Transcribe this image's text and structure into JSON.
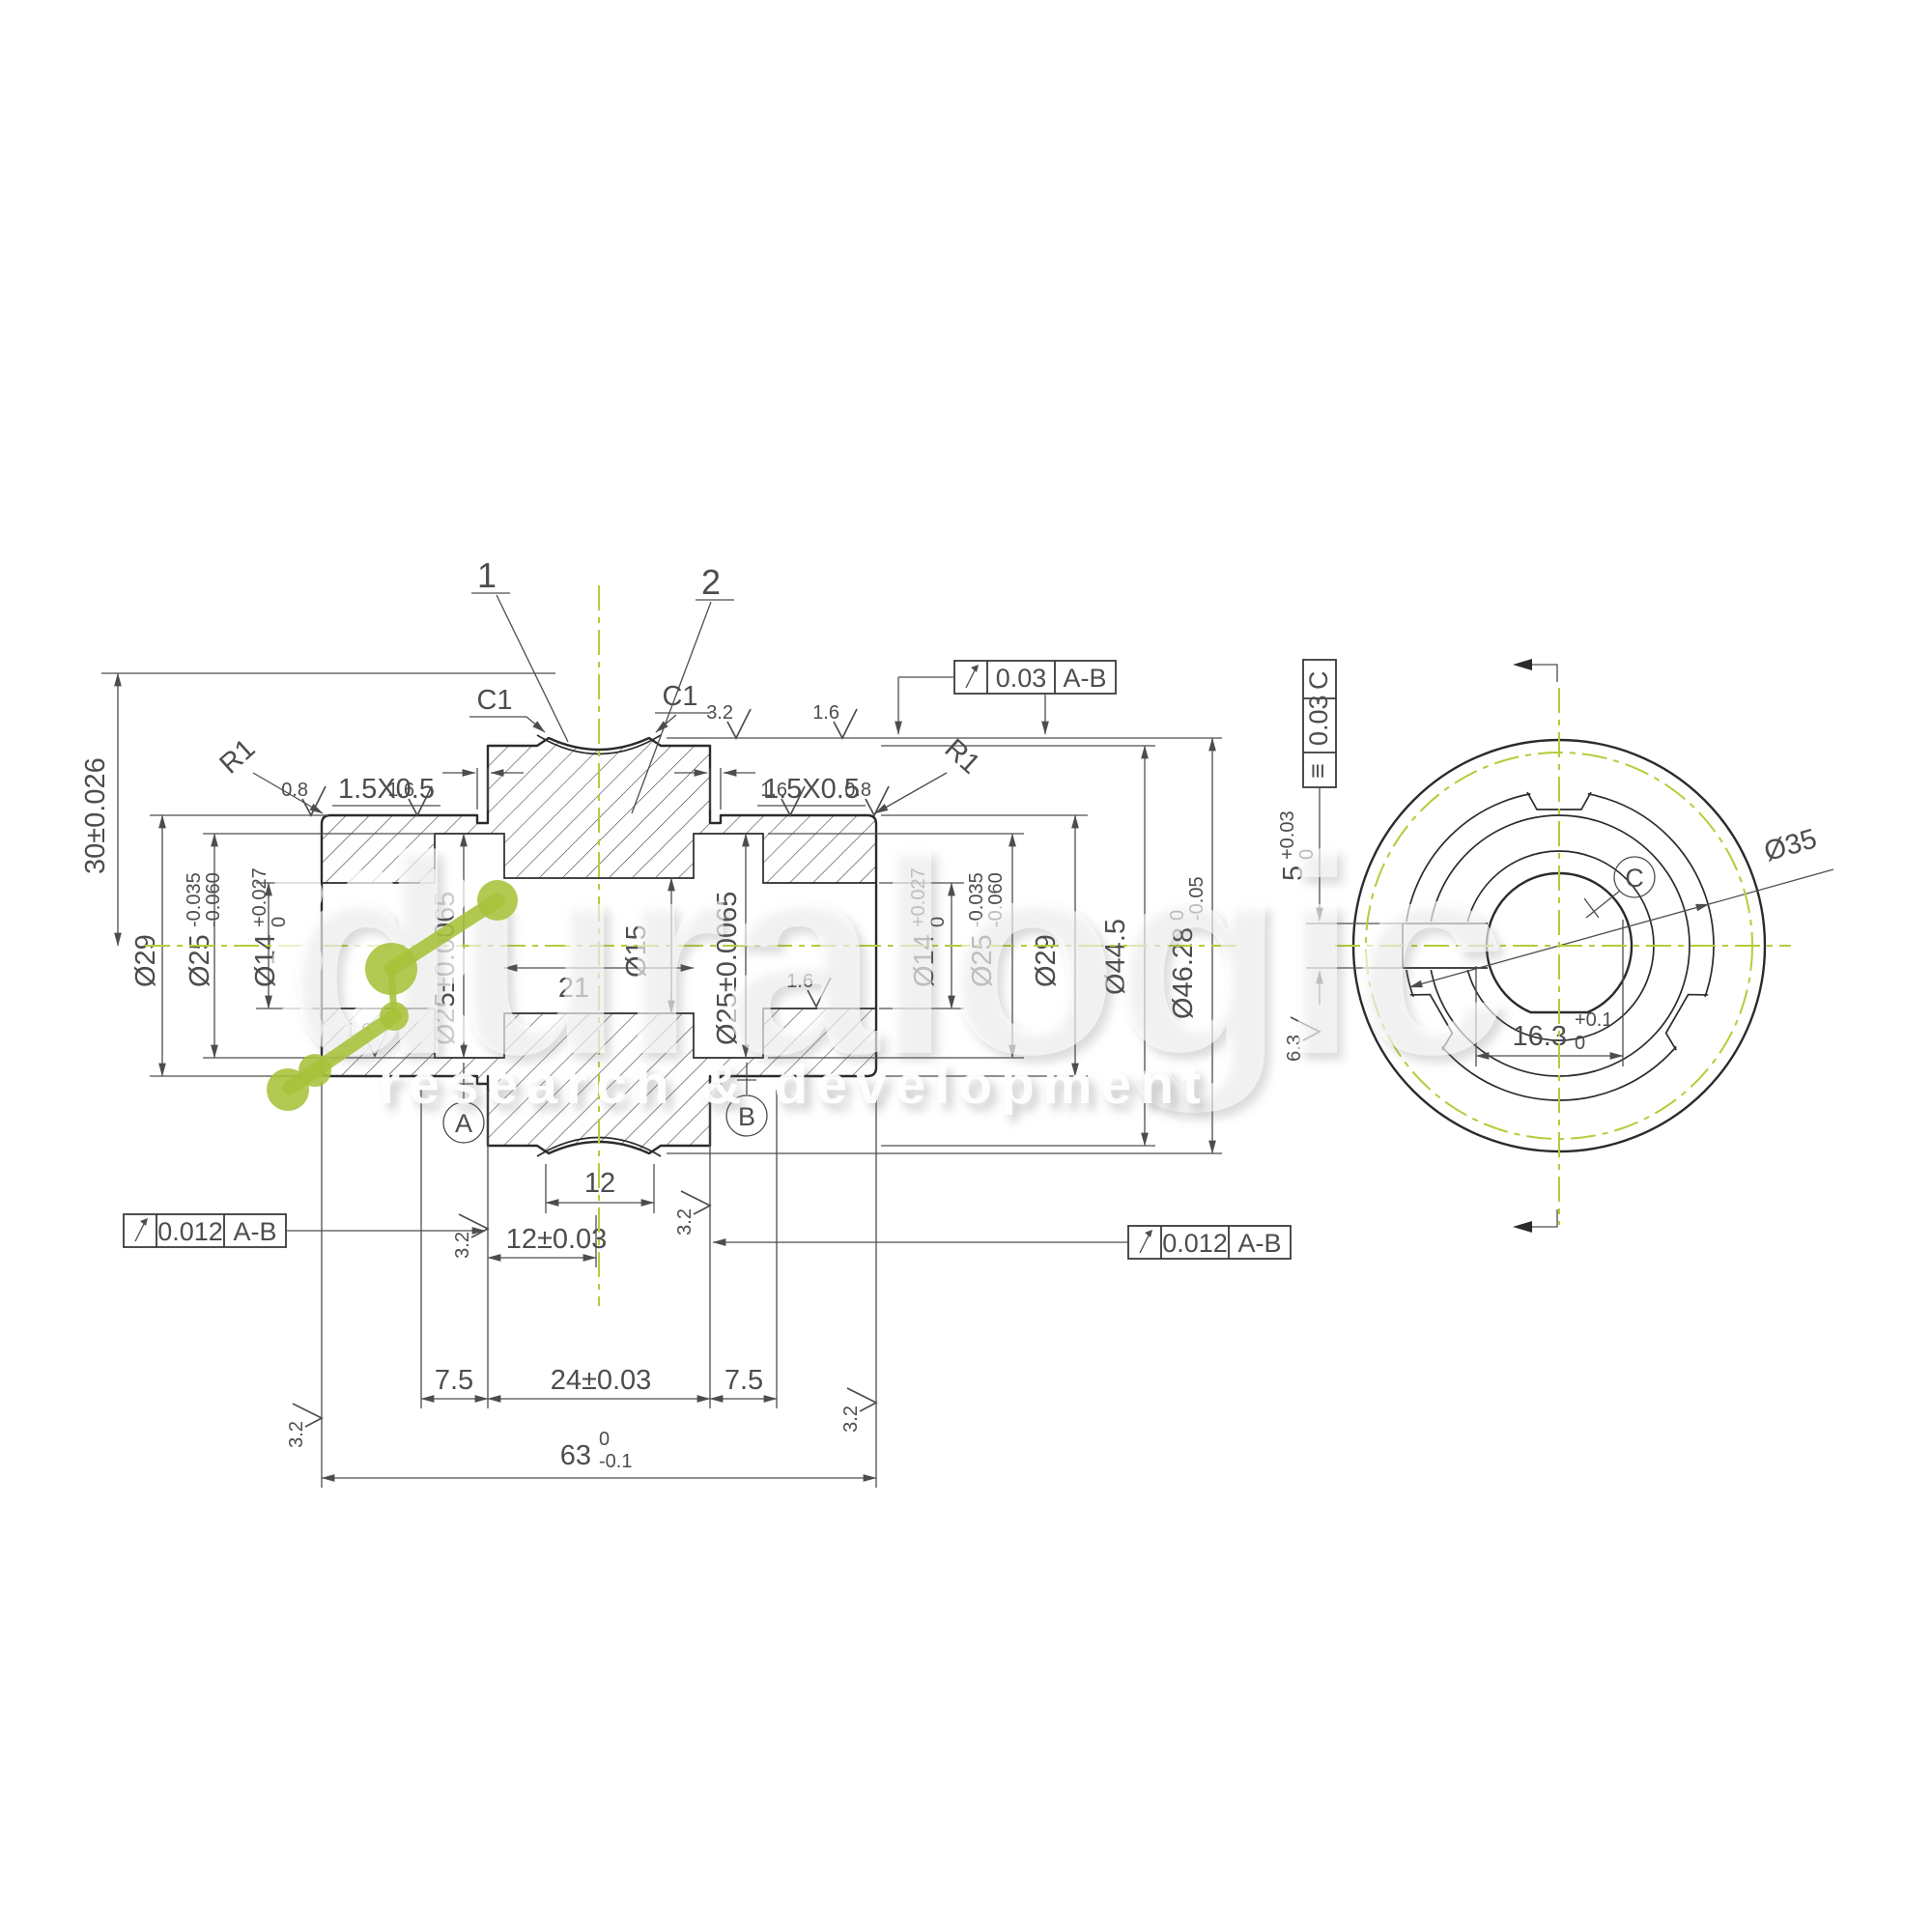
{
  "watermark": {
    "brand": "duralogic",
    "tagline": "research & development"
  },
  "colors": {
    "line": "#2b2b2b",
    "dim_text": "#4d4d4d",
    "centerline_green": "#b5cc3a",
    "logo_green": "#a7c23a"
  },
  "balloons": {
    "item1": "1",
    "item2": "2"
  },
  "labels": {
    "chamfer_c1": "C1",
    "corner_chamfer": "1.5X0.5",
    "fillet_r1": "R1"
  },
  "finish": {
    "f08": "0.8",
    "f16": "1.6",
    "f32": "3.2",
    "f63": "6.3"
  },
  "dims": {
    "d30": "30±0.026",
    "d29": "Ø29",
    "d25": {
      "v": "Ø25",
      "up": "-0.035",
      "dn": "-0.060"
    },
    "d14": {
      "v": "Ø14",
      "up": "+0.027",
      "dn": "0"
    },
    "d25c": "Ø25±0.0065",
    "d15": "Ø15",
    "l21": "21",
    "d445": "Ø44.5",
    "d4628": {
      "v": "Ø46.28",
      "up": "0",
      "dn": "-0.05"
    },
    "b12": "12",
    "l12": "12±0.03",
    "l75": "7.5",
    "l24": "24±0.03",
    "l63": {
      "v": "63",
      "up": "0",
      "dn": "-0.1"
    }
  },
  "gdt": {
    "runout_top": {
      "value": "0.03",
      "datum": "A-B"
    },
    "runout_left": {
      "value": "0.012",
      "datum": "A-B"
    },
    "runout_right": {
      "value": "0.012",
      "datum": "A-B"
    },
    "symmetry": {
      "sym": "≡",
      "value": "0.03",
      "datum": "C"
    }
  },
  "datums": {
    "a": "A",
    "b": "B",
    "c": "C"
  },
  "end_view": {
    "d35": "Ø35",
    "d163": {
      "v": "16.3",
      "up": "+0.1",
      "dn": "0"
    },
    "d5": {
      "v": "5",
      "up": "+0.03",
      "dn": "0"
    }
  }
}
